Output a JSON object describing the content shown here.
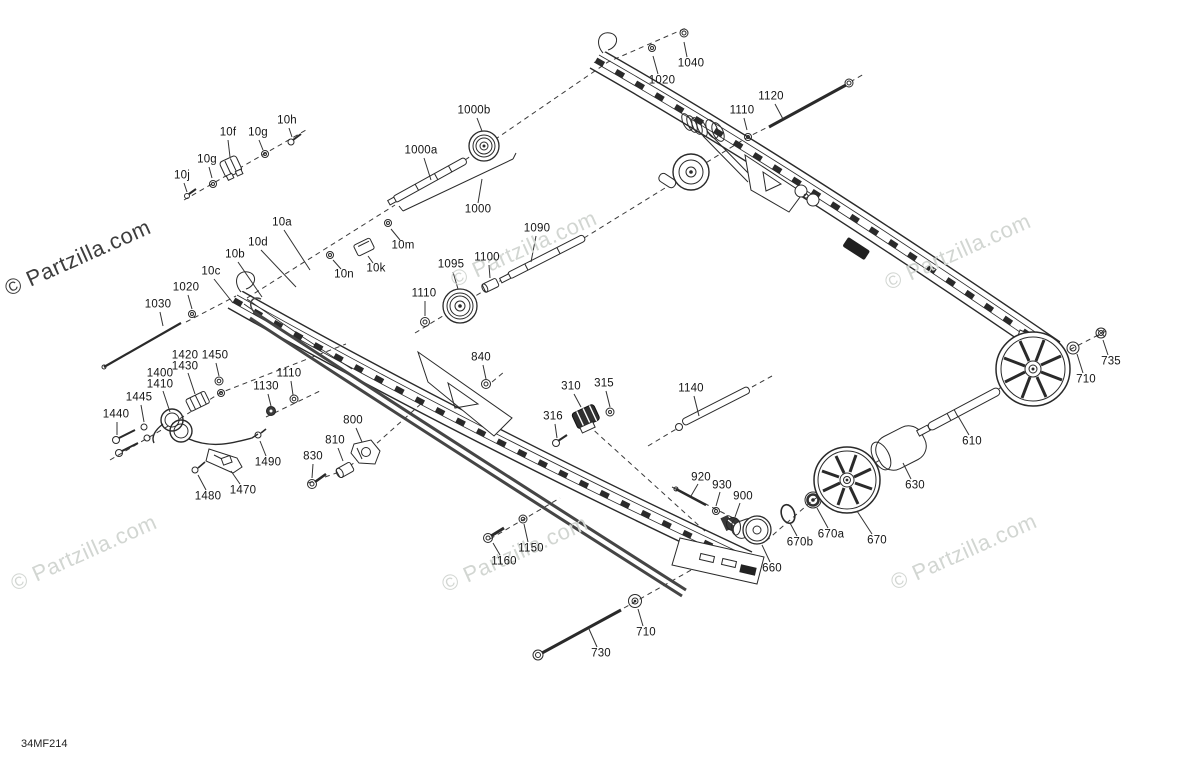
{
  "diagram": {
    "part_code": "34MF214",
    "watermark_text": "© Partzilla.com",
    "colors": {
      "line": "#2a2a2a",
      "dash": "#3a3a3a",
      "watermark_light": "#d2d6d2",
      "watermark_dark": "#3d3d3d",
      "label": "#141414"
    },
    "watermarks": [
      {
        "x": 6,
        "y": 290,
        "dark": true
      },
      {
        "x": 452,
        "y": 281,
        "dark": false
      },
      {
        "x": 886,
        "y": 284,
        "dark": false
      },
      {
        "x": 12,
        "y": 585,
        "dark": false
      },
      {
        "x": 443,
        "y": 586,
        "dark": false
      },
      {
        "x": 892,
        "y": 584,
        "dark": false
      },
      {
        "x": 888,
        "y": -6,
        "dark": false
      }
    ],
    "labels": [
      {
        "t": "1040",
        "x": 691,
        "y": 64,
        "l": [
          687,
          57,
          684,
          42
        ]
      },
      {
        "t": "1020",
        "x": 662,
        "y": 81,
        "l": [
          658,
          74,
          653,
          56
        ]
      },
      {
        "t": "1110",
        "x": 742,
        "y": 111,
        "l": [
          744,
          118,
          747,
          130
        ]
      },
      {
        "t": "1120",
        "x": 771,
        "y": 97,
        "l": [
          775,
          104,
          783,
          119
        ]
      },
      {
        "t": "1000b",
        "x": 474,
        "y": 111,
        "l": [
          477,
          118,
          482,
          131
        ]
      },
      {
        "t": "1000a",
        "x": 421,
        "y": 151,
        "l": [
          424,
          158,
          431,
          180
        ]
      },
      {
        "t": "1000",
        "x": 478,
        "y": 210,
        "l": [
          478,
          203,
          482,
          179
        ]
      },
      {
        "t": "10f",
        "x": 228,
        "y": 133,
        "l": [
          228,
          140,
          230,
          157
        ]
      },
      {
        "t": "10g",
        "x": 258,
        "y": 133,
        "l": [
          259,
          140,
          263,
          150
        ]
      },
      {
        "t": "10h",
        "x": 287,
        "y": 121,
        "l": [
          289,
          128,
          292,
          137
        ]
      },
      {
        "t": "10g",
        "x": 207,
        "y": 160,
        "l": [
          209,
          167,
          212,
          178
        ]
      },
      {
        "t": "10j",
        "x": 182,
        "y": 176,
        "l": [
          184,
          183,
          187,
          192
        ]
      },
      {
        "t": "10a",
        "x": 282,
        "y": 223,
        "l": [
          284,
          230,
          310,
          270
        ]
      },
      {
        "t": "10d",
        "x": 258,
        "y": 243,
        "l": [
          261,
          250,
          296,
          287
        ]
      },
      {
        "t": "10b",
        "x": 235,
        "y": 255,
        "l": [
          238,
          262,
          262,
          297
        ]
      },
      {
        "t": "10c",
        "x": 211,
        "y": 272,
        "l": [
          214,
          279,
          233,
          303
        ]
      },
      {
        "t": "1020",
        "x": 186,
        "y": 288,
        "l": [
          188,
          295,
          192,
          309
        ]
      },
      {
        "t": "10m",
        "x": 403,
        "y": 246,
        "l": [
          400,
          240,
          391,
          229
        ]
      },
      {
        "t": "10k",
        "x": 376,
        "y": 269,
        "l": [
          373,
          263,
          368,
          256
        ]
      },
      {
        "t": "10n",
        "x": 344,
        "y": 275,
        "l": [
          341,
          269,
          333,
          260
        ]
      },
      {
        "t": "1090",
        "x": 537,
        "y": 229,
        "l": [
          536,
          236,
          531,
          262
        ]
      },
      {
        "t": "1100",
        "x": 487,
        "y": 258,
        "l": [
          489,
          265,
          490,
          278
        ]
      },
      {
        "t": "1095",
        "x": 451,
        "y": 265,
        "l": [
          453,
          272,
          458,
          289
        ]
      },
      {
        "t": "1110",
        "x": 424,
        "y": 294,
        "l": [
          425,
          301,
          425,
          316
        ]
      },
      {
        "t": "1030",
        "x": 158,
        "y": 305,
        "l": [
          160,
          312,
          163,
          326
        ]
      },
      {
        "t": "1420",
        "x": 185,
        "y": 356,
        "l": null
      },
      {
        "t": "1430",
        "x": 185,
        "y": 367,
        "l": [
          188,
          373,
          195,
          394
        ]
      },
      {
        "t": "1450",
        "x": 215,
        "y": 356,
        "l": [
          216,
          363,
          219,
          376
        ]
      },
      {
        "t": "1400",
        "x": 160,
        "y": 374,
        "l": null
      },
      {
        "t": "1410",
        "x": 160,
        "y": 385,
        "l": [
          163,
          391,
          170,
          412
        ]
      },
      {
        "t": "1445",
        "x": 139,
        "y": 398,
        "l": [
          141,
          405,
          144,
          422
        ]
      },
      {
        "t": "1440",
        "x": 116,
        "y": 415,
        "l": [
          117,
          422,
          117,
          435
        ]
      },
      {
        "t": "1130",
        "x": 266,
        "y": 387,
        "l": [
          268,
          394,
          271,
          406
        ]
      },
      {
        "t": "1110",
        "x": 289,
        "y": 374,
        "l": [
          291,
          381,
          293,
          395
        ]
      },
      {
        "t": "840",
        "x": 481,
        "y": 358,
        "l": [
          483,
          365,
          486,
          379
        ]
      },
      {
        "t": "310",
        "x": 571,
        "y": 387,
        "l": [
          574,
          394,
          581,
          407
        ]
      },
      {
        "t": "315",
        "x": 604,
        "y": 384,
        "l": [
          606,
          391,
          610,
          407
        ]
      },
      {
        "t": "316",
        "x": 553,
        "y": 417,
        "l": [
          555,
          424,
          557,
          438
        ]
      },
      {
        "t": "1140",
        "x": 691,
        "y": 389,
        "l": [
          694,
          396,
          699,
          416
        ]
      },
      {
        "t": "800",
        "x": 353,
        "y": 421,
        "l": [
          356,
          428,
          362,
          442
        ]
      },
      {
        "t": "810",
        "x": 335,
        "y": 441,
        "l": [
          338,
          448,
          343,
          461
        ]
      },
      {
        "t": "830",
        "x": 313,
        "y": 457,
        "l": [
          313,
          464,
          312,
          478
        ]
      },
      {
        "t": "1490",
        "x": 268,
        "y": 463,
        "l": [
          266,
          456,
          260,
          441
        ]
      },
      {
        "t": "1480",
        "x": 208,
        "y": 497,
        "l": [
          206,
          490,
          198,
          475
        ]
      },
      {
        "t": "1470",
        "x": 243,
        "y": 491,
        "l": [
          240,
          484,
          231,
          471
        ]
      },
      {
        "t": "920",
        "x": 701,
        "y": 478,
        "l": [
          698,
          484,
          691,
          496
        ]
      },
      {
        "t": "930",
        "x": 722,
        "y": 486,
        "l": [
          720,
          492,
          716,
          506
        ]
      },
      {
        "t": "900",
        "x": 743,
        "y": 497,
        "l": [
          740,
          503,
          735,
          517
        ]
      },
      {
        "t": "670b",
        "x": 800,
        "y": 543,
        "l": [
          797,
          536,
          790,
          523
        ]
      },
      {
        "t": "670a",
        "x": 831,
        "y": 535,
        "l": [
          828,
          528,
          817,
          508
        ]
      },
      {
        "t": "670",
        "x": 877,
        "y": 541,
        "l": [
          872,
          534,
          857,
          511
        ]
      },
      {
        "t": "660",
        "x": 772,
        "y": 569,
        "l": [
          770,
          562,
          762,
          545
        ]
      },
      {
        "t": "630",
        "x": 915,
        "y": 486,
        "l": [
          911,
          479,
          903,
          463
        ]
      },
      {
        "t": "610",
        "x": 972,
        "y": 442,
        "l": [
          969,
          435,
          958,
          416
        ]
      },
      {
        "t": "710",
        "x": 1086,
        "y": 380,
        "l": [
          1083,
          373,
          1077,
          354
        ]
      },
      {
        "t": "735",
        "x": 1111,
        "y": 362,
        "l": [
          1108,
          355,
          1103,
          340
        ]
      },
      {
        "t": "1150",
        "x": 531,
        "y": 549,
        "l": [
          528,
          542,
          524,
          524
        ]
      },
      {
        "t": "1160",
        "x": 504,
        "y": 562,
        "l": [
          500,
          555,
          493,
          543
        ]
      },
      {
        "t": "710",
        "x": 646,
        "y": 633,
        "l": [
          643,
          626,
          638,
          609
        ]
      },
      {
        "t": "730",
        "x": 601,
        "y": 654,
        "l": [
          597,
          647,
          589,
          629
        ]
      }
    ]
  }
}
